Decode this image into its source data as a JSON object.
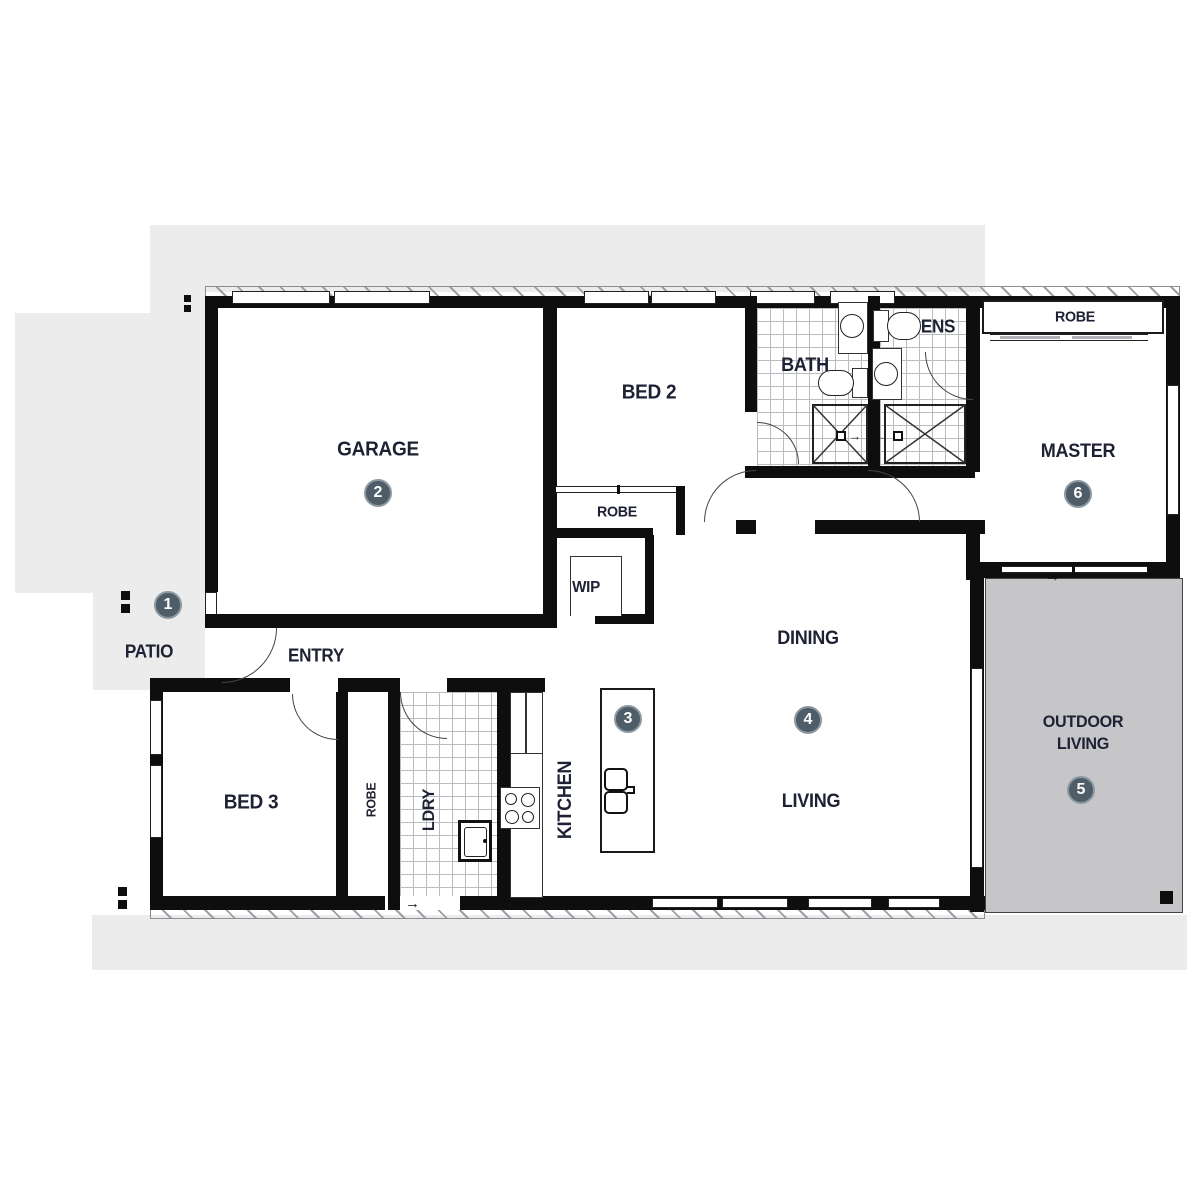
{
  "title": "House floor plan",
  "rooms": {
    "garage": {
      "label": "GARAGE"
    },
    "bed2": {
      "label": "BED 2"
    },
    "robe_bed2": {
      "label": "ROBE"
    },
    "wip": {
      "label": "WIP"
    },
    "bath": {
      "label": "BATH"
    },
    "ens": {
      "label": "ENS"
    },
    "robe_master": {
      "label": "ROBE"
    },
    "master": {
      "label": "MASTER"
    },
    "dining": {
      "label": "DINING"
    },
    "living": {
      "label": "LIVING"
    },
    "kitchen": {
      "label": "KITCHEN"
    },
    "laundry": {
      "label": "LDRY"
    },
    "robe_bed3": {
      "label": "ROBE"
    },
    "bed3": {
      "label": "BED 3"
    },
    "entry": {
      "label": "ENTRY"
    },
    "patio": {
      "label": "PATIO"
    },
    "outdoor_living": {
      "line1": "OUTDOOR",
      "line2": "LIVING"
    }
  },
  "markers": [
    {
      "number": "1",
      "area": "patio"
    },
    {
      "number": "2",
      "area": "garage"
    },
    {
      "number": "3",
      "area": "kitchen-island"
    },
    {
      "number": "4",
      "area": "dining-living"
    },
    {
      "number": "5",
      "area": "outdoor-living"
    },
    {
      "number": "6",
      "area": "master"
    }
  ],
  "icons": {
    "arrow_right": "→"
  },
  "colors": {
    "site_gray": "#ececec",
    "outdoor_living_gray": "#c6c6c9",
    "wall_black": "#0e0e0e",
    "marker_fill": "#4e5d68",
    "label_text": "#1d2133"
  }
}
